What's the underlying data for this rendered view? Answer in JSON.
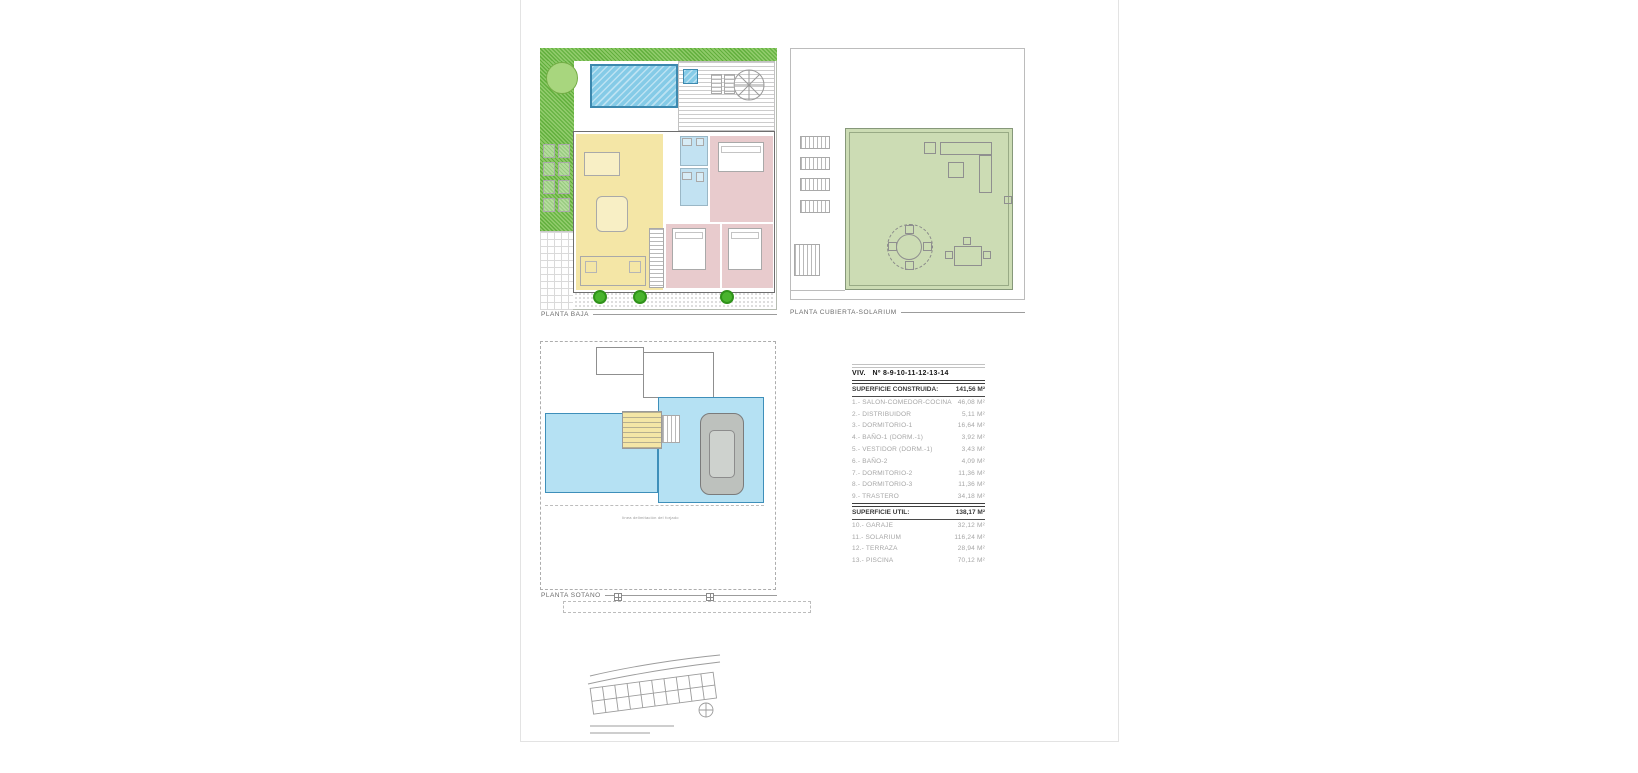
{
  "colors": {
    "pool_blue": "#85cbe7",
    "pool_border": "#3c88ae",
    "room_yellow": "#f4e6a6",
    "room_pink": "#e8cbcd",
    "bath_blue": "#c2e2f2",
    "solarium_green": "#ccdcb4",
    "grass_green_a": "#61af3c",
    "grass_green_b": "#8fca6a",
    "tree_green": "#49b42e",
    "tree_green_dark": "#2f921a",
    "basement_blue": "#b5e1f3",
    "basement_border": "#3e8fba"
  },
  "plans": {
    "planta_baja": {
      "label": "PLANTA BAJA"
    },
    "planta_cubierta": {
      "label": "PLANTA CUBIERTA-SOLARIUM"
    },
    "planta_sotano": {
      "label": "PLANTA SOTANO",
      "annotation": "línea delimitación del forjado"
    }
  },
  "area_table": {
    "title": "VIV.   Nº 8-9-10-11-12-13-14",
    "constructed_header": {
      "label": "SUPERFICIE CONSTRUIDA:",
      "value": "141,56 M²"
    },
    "constructed_rows": [
      {
        "label": "1.- SALON-COMEDOR-COCINA",
        "value": "46,08 M²"
      },
      {
        "label": "2.- DISTRIBUIDOR",
        "value": "5,11 M²"
      },
      {
        "label": "3.- DORMITORIO-1",
        "value": "16,64 M²"
      },
      {
        "label": "4.- BAÑO-1  (DORM.-1)",
        "value": "3,92 M²"
      },
      {
        "label": "5.- VESTIDOR (DORM.-1)",
        "value": "3,43 M²"
      },
      {
        "label": "6.- BAÑO-2",
        "value": "4,09 M²"
      },
      {
        "label": "7.- DORMITORIO-2",
        "value": "11,36 M²"
      },
      {
        "label": "8.- DORMITORIO-3",
        "value": "11,36 M²"
      },
      {
        "label": "9.- TRASTERO",
        "value": "34,18 M²"
      }
    ],
    "util_header": {
      "label": "SUPERFICIE UTIL:",
      "value": "138,17 M²"
    },
    "util_rows": [
      {
        "label": "10.- GARAJE",
        "value": "32,12 M²"
      },
      {
        "label": "11.- SOLARIUM",
        "value": "116,24 M²"
      },
      {
        "label": "12.- TERRAZA",
        "value": "28,94 M²"
      },
      {
        "label": "13.- PISCINA",
        "value": "70,12 M²"
      }
    ]
  }
}
